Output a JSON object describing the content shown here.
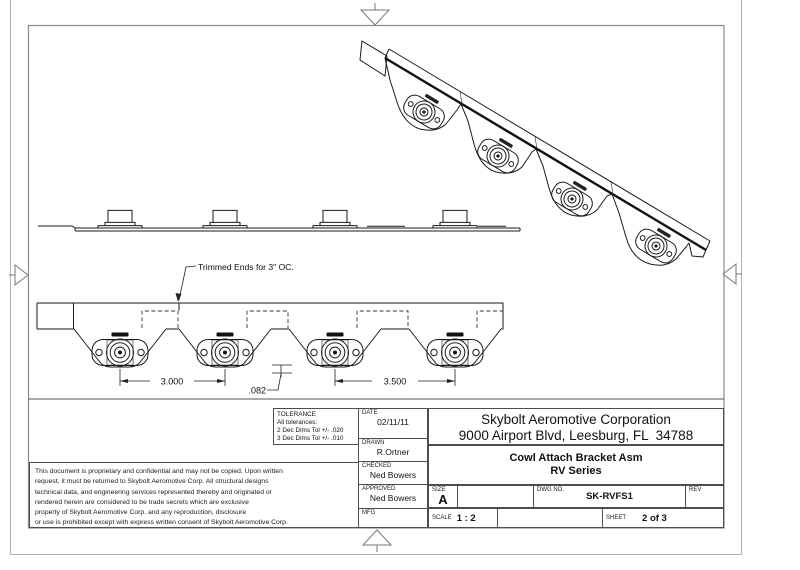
{
  "drawing": {
    "annotation_trimmed_ends": "Trimmed Ends for 3\" OC.",
    "dim_3000": "3.000",
    "dim_082": ".082",
    "dim_3500": "3.500"
  },
  "tolerance_block": {
    "title": "TOLERANCE",
    "line1": "All tolerances:",
    "line2": "2 Dec Dims Tol +/- .020",
    "line3": "3 Dec Dims Tol +/- .010"
  },
  "approval_block": {
    "date_label": "DATE",
    "date_value": "02/11/11",
    "drawn_label": "DRAWN",
    "drawn_value": "R.Ortner",
    "checked_label": "CHECKED",
    "checked_value": "Ned Bowers",
    "approved_label": "APPROVED",
    "approved_value": "Ned Bowers",
    "mfg_label": "MFG",
    "mfg_value": ""
  },
  "title_block": {
    "company_name": "Skybolt Aeromotive Corporation",
    "company_address": "9000 Airport Blvd, Leesburg, FL  34788",
    "drawing_title_line1": "Cowl Attach Bracket Asm",
    "drawing_title_line2": "RV Series",
    "size_label": "SIZE",
    "size_value": "A",
    "dwg_label": "DWG NO.",
    "dwg_value": "SK-RVFS1",
    "rev_label": "REV",
    "rev_value": "",
    "scale_label": "SCALE",
    "scale_value": "1 : 2",
    "sheet_label": "SHEET",
    "sheet_value": "2 of 3"
  },
  "proprietary_note": "This document is proprietary and confidential and may not be copied. Upon written\nrequest, it must be returned to Skybolt Aeromotive Corp. All structural designs\ntechnical data, and engineering services represented thereby and originated or\nrendered herein are considered to be trade secrets which are exclusive\nproperty of Skybolt Aeromotive Corp. and any reproduction, disclosure\nor use is prohibited except with express written consent of Skybolt Aeromotive Corp."
}
